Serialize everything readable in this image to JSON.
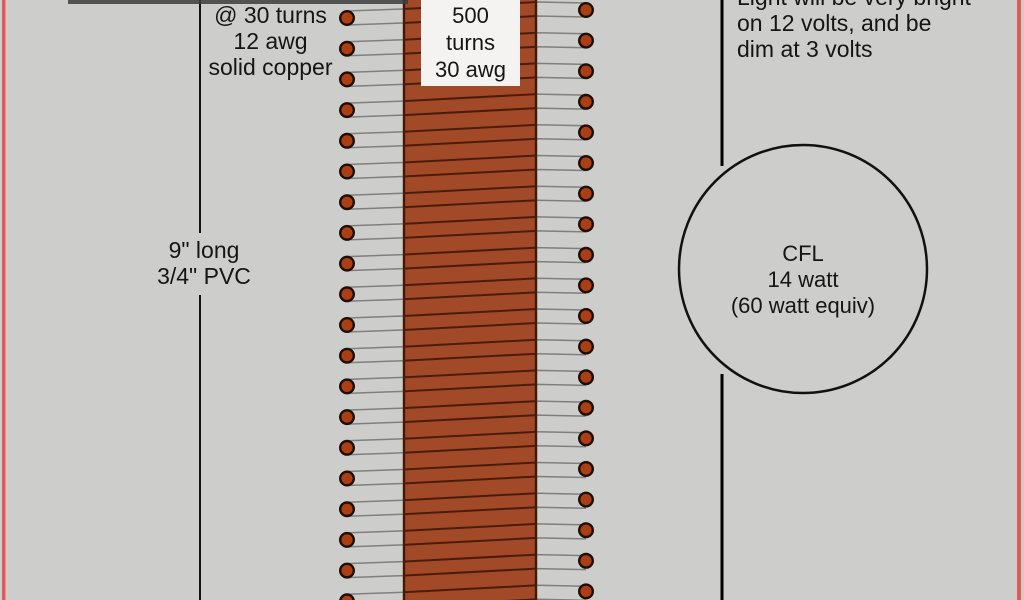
{
  "labels": {
    "primary_winding": "@ 30 turns\n12 awg\nsolid copper",
    "secondary_winding": "500\nturns\n30 awg",
    "pvc_pipe": "9\" long\n3/4\" PVC",
    "brightness_note": "Light will be very bright\non 12 volts, and be\ndim at 3 volts",
    "cfl_bulb": "CFL\n14 watt\n(60 watt equiv)"
  },
  "colors": {
    "background": "#cdcdcc",
    "border_red": "#e15a56",
    "coil_body": "#a24a28",
    "coil_edge": "#431705",
    "winding_dark": "#4a1c08",
    "wire_gray": "#7f7f7f",
    "dot_fill": "#ab3e14",
    "dot_stroke": "#1c0e03",
    "line_black": "#111111",
    "label_box": "#f4f3f1"
  },
  "drawing": {
    "coil": {
      "x": 403,
      "w": 134
    },
    "left_dots": {
      "x": 347,
      "y_start": 18,
      "spacing": 30.7,
      "count": 20
    },
    "right_dots": {
      "x": 586,
      "y_start": 10,
      "spacing": 30.6,
      "count": 20
    },
    "dot_radius": 6.8,
    "windings": {
      "count": 20,
      "pair_offsets": [
        -7,
        7
      ]
    },
    "dimension_line": {
      "x": 200,
      "gap_top": 233,
      "gap_bottom": 295
    },
    "circuit_line": {
      "x": 722,
      "gap_top": 166,
      "gap_bottom": 374
    },
    "cfl_circle": {
      "cx": 803,
      "cy": 269,
      "r": 124
    }
  }
}
